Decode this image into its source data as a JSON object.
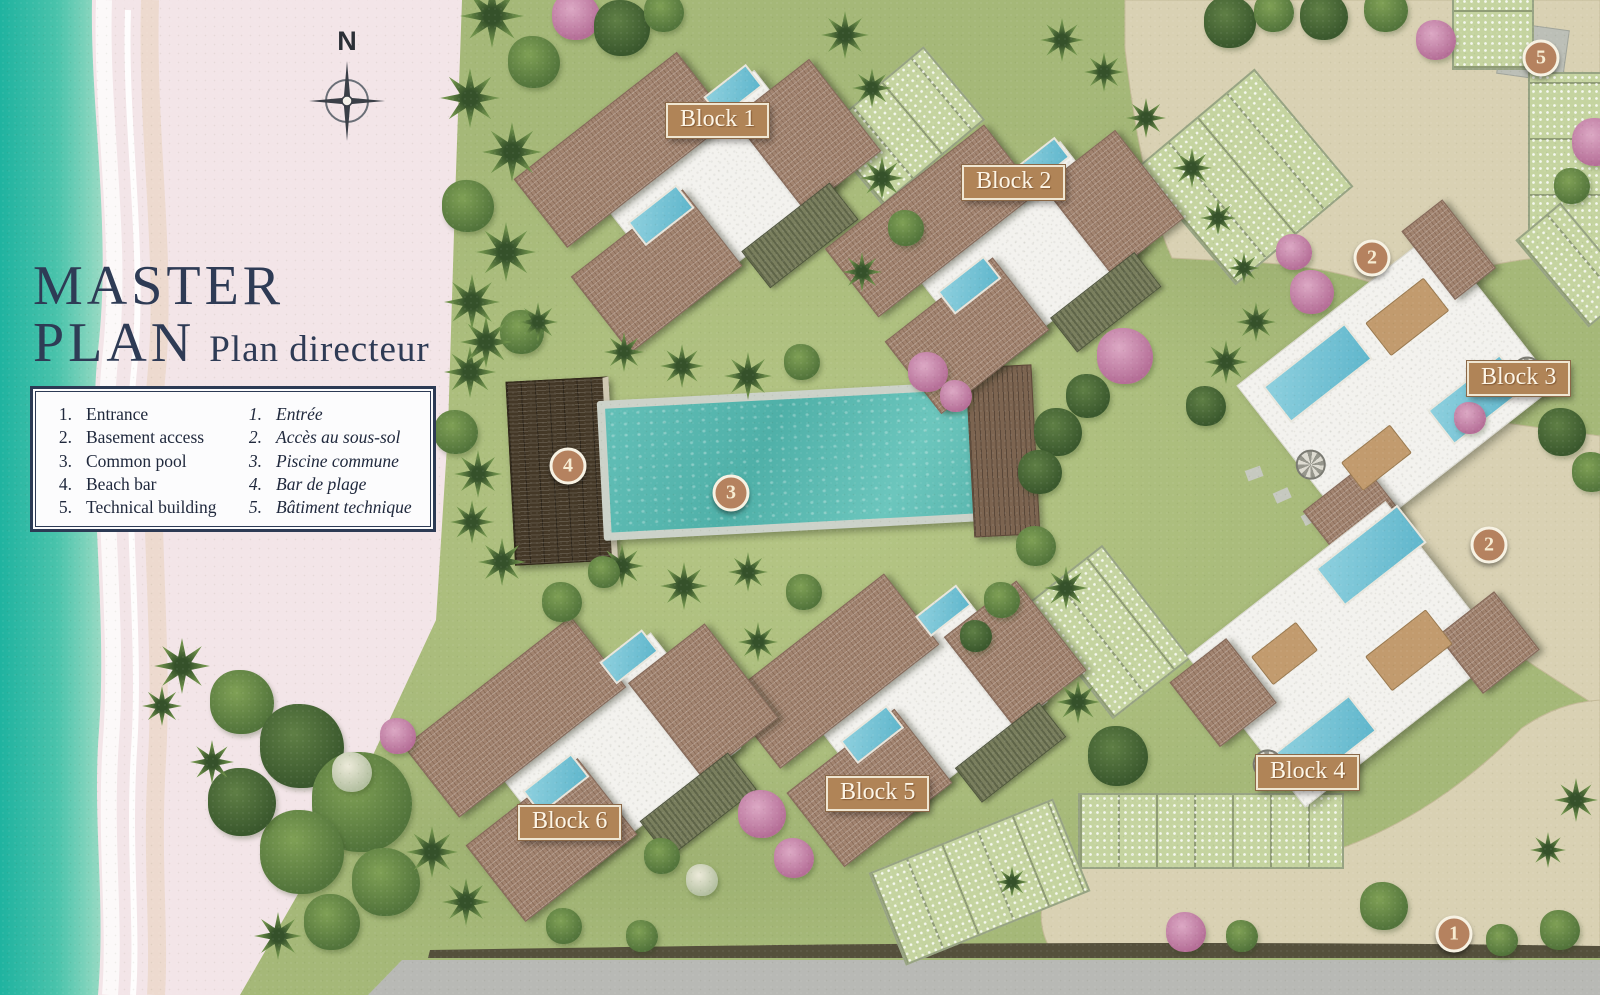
{
  "title": {
    "main_line1": "MASTER",
    "main_line2": "PLAN",
    "subtitle": "Plan directeur"
  },
  "compass": {
    "north_label": "N"
  },
  "legend": {
    "items_en": [
      {
        "num": "1.",
        "label": "Entrance"
      },
      {
        "num": "2.",
        "label": "Basement access"
      },
      {
        "num": "3.",
        "label": "Common pool"
      },
      {
        "num": "4.",
        "label": "Beach bar"
      },
      {
        "num": "5.",
        "label": "Technical building"
      }
    ],
    "items_fr": [
      {
        "num": "1.",
        "label": "Entrée"
      },
      {
        "num": "2.",
        "label": "Accès au sous-sol"
      },
      {
        "num": "3.",
        "label": "Piscine commune"
      },
      {
        "num": "4.",
        "label": "Bar de plage"
      },
      {
        "num": "5.",
        "label": "Bâtiment technique"
      }
    ]
  },
  "block_labels": [
    {
      "label": "Block 1"
    },
    {
      "label": "Block 2"
    },
    {
      "label": "Block 3"
    },
    {
      "label": "Block 4"
    },
    {
      "label": "Block 5"
    },
    {
      "label": "Block 6"
    }
  ],
  "markers": [
    {
      "number": "5"
    },
    {
      "number": "2"
    },
    {
      "number": "2"
    },
    {
      "number": "3"
    },
    {
      "number": "4"
    },
    {
      "number": "1"
    }
  ],
  "colors": {
    "ocean": "#2cb7a3",
    "beach_sand": "#f3e5e8",
    "lawn": "#a5b878",
    "path": "#d9d1b3",
    "marker_fill": "#b5825f",
    "label_bg": "#b08457",
    "navy_text": "#2e3b55"
  }
}
